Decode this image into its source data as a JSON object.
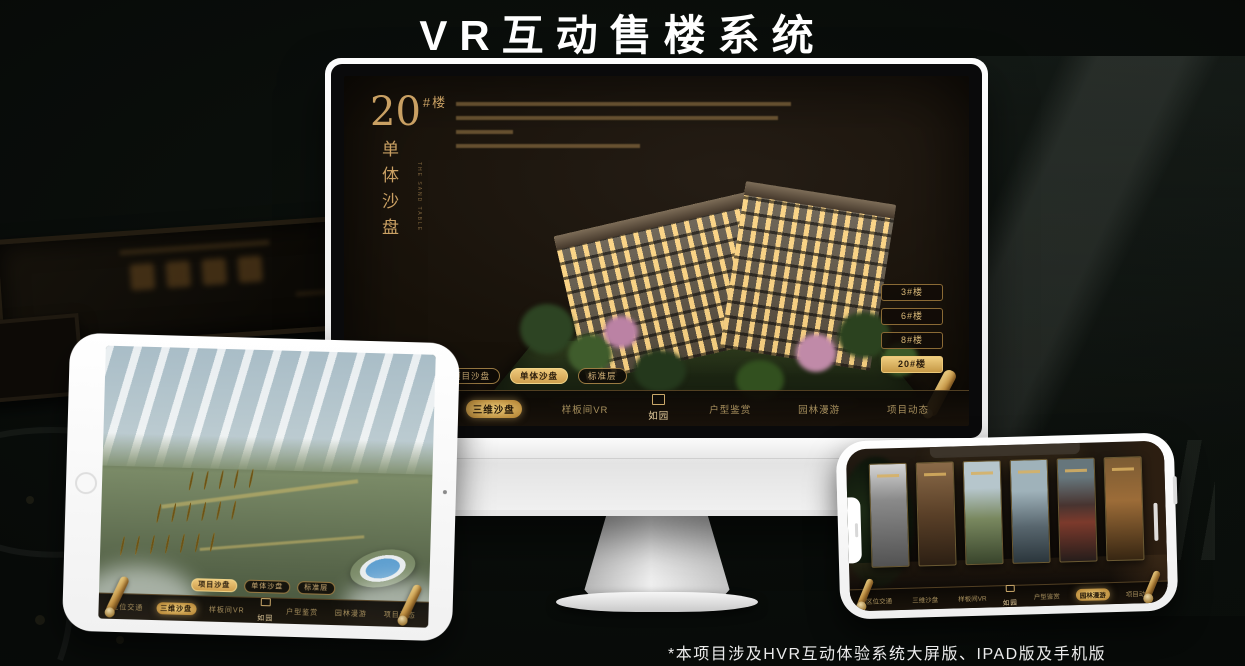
{
  "page": {
    "title": "VR互动售楼系统",
    "footnote": "*本项目涉及HVR互动体验系统大屏版、IPAD版及手机版"
  },
  "colors": {
    "gold": "#c9a063",
    "gold_active": "#e9c878",
    "screen_bg": "#171109",
    "frame_white": "#f4f4f4"
  },
  "sandtable": {
    "headline": {
      "number": "20",
      "suffix": "#楼",
      "subtitle": "单体沙盘"
    },
    "building_buttons": [
      "3#楼",
      "6#楼",
      "8#楼",
      "20#楼"
    ],
    "active_building": "20#楼",
    "tabs": [
      "项目沙盘",
      "单体沙盘",
      "标准层"
    ],
    "monitor_active_tab": "单体沙盘",
    "tablet_active_tab": "项目沙盘",
    "nav_items": [
      "区位交通",
      "三维沙盘",
      "样板间VR",
      "户型鉴赏",
      "园林漫游",
      "项目动态"
    ],
    "monitor_active_nav": "三维沙盘",
    "tablet_active_nav": "三维沙盘",
    "phone_active_nav": "园林漫游",
    "logo": "如园"
  }
}
